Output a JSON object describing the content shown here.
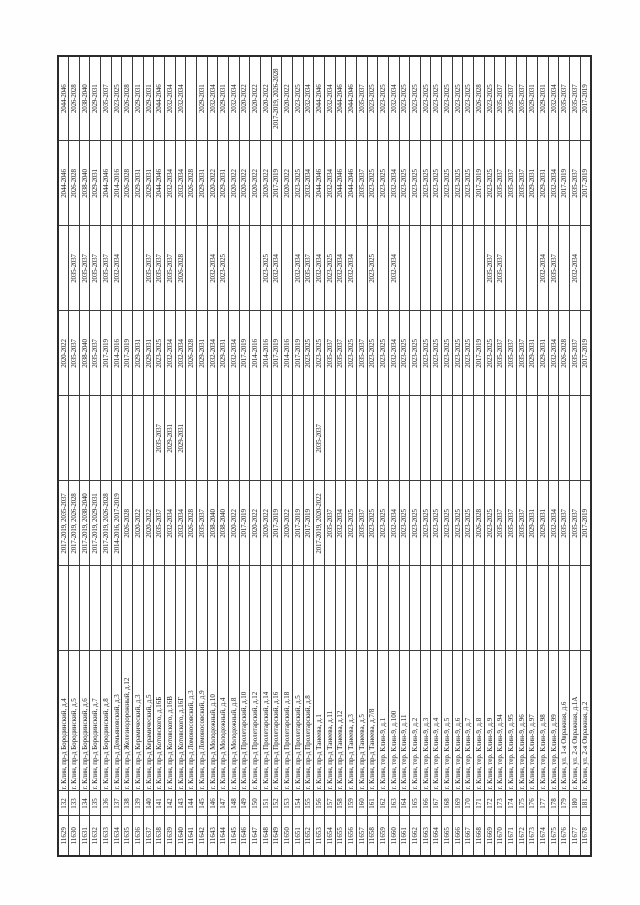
{
  "page": {
    "background": "#ffffff",
    "ink": "#1c1c1c",
    "border": "#3c3c3c"
  },
  "table": {
    "column_widths": [
      40,
      25,
      140,
      85,
      85,
      85,
      85,
      85,
      85,
      85
    ],
    "rows": [
      {
        "id": "11629",
        "num": "132",
        "address": "г. Клин, пр-д Бородинский, д.4",
        "periods": [
          "",
          "2017-2019, 2035-2037",
          "",
          "2020-2022",
          "",
          "2044-2046",
          "2044-2046"
        ]
      },
      {
        "id": "11630",
        "num": "133",
        "address": "г. Клин, пр-д Бородинский, д.5",
        "periods": [
          "",
          "2017-2019, 2026-2028",
          "",
          "2035-2037",
          "2035-2037",
          "2026-2028",
          "2026-2028"
        ]
      },
      {
        "id": "11631",
        "num": "134",
        "address": "г. Клин, пр-д Бородинский, д.6",
        "periods": [
          "",
          "2017-2019, 2038-2040",
          "",
          "2038-2040",
          "2035-2037",
          "2038-2040",
          "2038-2040"
        ]
      },
      {
        "id": "11632",
        "num": "135",
        "address": "г. Клин, пр-д Бородинский, д.7",
        "periods": [
          "",
          "2017-2019, 2029-2031",
          "",
          "2035-2037",
          "2035-2037",
          "2029-2031",
          "2029-2031"
        ]
      },
      {
        "id": "11633",
        "num": "136",
        "address": "г. Клин, пр-д Бородинский, д.8",
        "periods": [
          "",
          "2017-2019, 2026-2028",
          "",
          "2017-2019",
          "2035-2037",
          "2044-2046",
          "2035-2037"
        ]
      },
      {
        "id": "11634",
        "num": "137",
        "address": "г. Клин, пр-д Демьяновский, д.3",
        "periods": [
          "",
          "2014-2016, 2017-2019",
          "",
          "2014-2016",
          "2032-2034",
          "2014-2016",
          "2023-2025"
        ]
      },
      {
        "id": "11635",
        "num": "138",
        "address": "г. Клин, пр-д Железнодорожный, д.12",
        "periods": [
          "",
          "2026-2028",
          "",
          "2017-2019",
          "",
          "2026-2028",
          "2026-2028"
        ]
      },
      {
        "id": "11636",
        "num": "139",
        "address": "г. Клин, пр-д Керамический, д.3",
        "periods": [
          "",
          "2020-2022",
          "",
          "2029-2031",
          "",
          "2029-2031",
          "2029-2031"
        ]
      },
      {
        "id": "11637",
        "num": "140",
        "address": "г. Клин, пр-д Керамический, д.5",
        "periods": [
          "",
          "2020-2022",
          "",
          "2029-2031",
          "2035-2037",
          "2029-2031",
          "2029-2031"
        ]
      },
      {
        "id": "11638",
        "num": "141",
        "address": "г. Клин, пр-д Котовского, д.16Б",
        "periods": [
          "",
          "2035-2037",
          "2035-2037",
          "2023-2025",
          "2035-2037",
          "2044-2046",
          "2044-2046"
        ]
      },
      {
        "id": "11639",
        "num": "142",
        "address": "г. Клин, пр-д Котовского, д.16В",
        "periods": [
          "",
          "2032-2034",
          "2029-2031",
          "2032-2034",
          "2035-2037",
          "2032-2034",
          "2032-2034"
        ]
      },
      {
        "id": "11640",
        "num": "143",
        "address": "г. Клин, пр-д Котовского, д.16Г",
        "periods": [
          "",
          "2032-2034",
          "2029-2031",
          "2032-2034",
          "2026-2028",
          "2032-2034",
          "2032-2034"
        ]
      },
      {
        "id": "11641",
        "num": "144",
        "address": "г. Клин, пр-д Ломоносовский, д.3",
        "periods": [
          "",
          "2026-2028",
          "",
          "2026-2028",
          "",
          "2026-2028",
          ""
        ]
      },
      {
        "id": "11642",
        "num": "145",
        "address": "г. Клин, пр-д Ломоносовский, д.9",
        "periods": [
          "",
          "2035-2037",
          "",
          "2029-2031",
          "",
          "2029-2031",
          "2029-2031"
        ]
      },
      {
        "id": "11643",
        "num": "146",
        "address": "г. Клин, пр-д Молодежный, д.10",
        "periods": [
          "",
          "2038-2040",
          "",
          "2032-2034",
          "2032-2034",
          "2020-2022",
          "2032-2034"
        ]
      },
      {
        "id": "11644",
        "num": "147",
        "address": "г. Клин, пр-д Молодежный, д.4",
        "periods": [
          "",
          "2038-2040",
          "",
          "2029-2031",
          "2023-2025",
          "2029-2031",
          "2029-2031"
        ]
      },
      {
        "id": "11645",
        "num": "148",
        "address": "г. Клин, пр-д Молодежный, д.8",
        "periods": [
          "",
          "2020-2022",
          "",
          "2032-2034",
          "",
          "2020-2022",
          "2032-2034"
        ]
      },
      {
        "id": "11646",
        "num": "149",
        "address": "г. Клин, пр-д Пролетарский, д.10",
        "periods": [
          "",
          "2017-2019",
          "",
          "2017-2019",
          "",
          "2020-2022",
          "2020-2022"
        ]
      },
      {
        "id": "11647",
        "num": "150",
        "address": "г. Клин, пр-д Пролетарский, д.12",
        "periods": [
          "",
          "2020-2022",
          "",
          "2014-2016",
          "",
          "2020-2022",
          "2020-2022"
        ]
      },
      {
        "id": "11648",
        "num": "151",
        "address": "г. Клин, пр-д Пролетарский, д.14",
        "periods": [
          "",
          "2020-2022",
          "",
          "2014-2016",
          "2023-2025",
          "2020-2022",
          "2020-2022"
        ]
      },
      {
        "id": "11649",
        "num": "152",
        "address": "г. Клин, пр-д Пролетарский, д.16",
        "periods": [
          "",
          "2017-2019",
          "",
          "2017-2019",
          "2032-2034",
          "2017-2019",
          "2017-2019, 2026-2028"
        ]
      },
      {
        "id": "11650",
        "num": "153",
        "address": "г. Клин, пр-д Пролетарский, д.18",
        "periods": [
          "",
          "2020-2022",
          "",
          "2014-2016",
          "",
          "2020-2022",
          "2020-2022"
        ]
      },
      {
        "id": "11651",
        "num": "154",
        "address": "г. Клин, пр-д Пролетарский, д.5",
        "periods": [
          "",
          "2017-2019",
          "",
          "2017-2019",
          "2032-2034",
          "2023-2025",
          "2023-2025"
        ]
      },
      {
        "id": "11652",
        "num": "155",
        "address": "г. Клин, пр-д Пролетарский, д.8",
        "periods": [
          "",
          "2017-2019",
          "",
          "2023-2025",
          "2035-2037",
          "2032-2034",
          "2032-2034"
        ]
      },
      {
        "id": "11653",
        "num": "156",
        "address": "г. Клин, пр-д Танеева, д.1",
        "periods": [
          "",
          "2017-2019, 2020-2022",
          "2035-2037",
          "2023-2025",
          "2032-2034",
          "2044-2046",
          "2044-2046"
        ]
      },
      {
        "id": "11654",
        "num": "157",
        "address": "г. Клин, пр-д Танеева, д.11",
        "periods": [
          "",
          "2035-2037",
          "",
          "2035-2037",
          "2023-2025",
          "2032-2034",
          "2032-2034"
        ]
      },
      {
        "id": "11655",
        "num": "158",
        "address": "г. Клин, пр-д Танеева, д.12",
        "periods": [
          "",
          "2032-2034",
          "",
          "2035-2037",
          "2032-2034",
          "2044-2046",
          "2044-2046"
        ]
      },
      {
        "id": "11656",
        "num": "159",
        "address": "г. Клин, пр-д Танеева, д.3",
        "periods": [
          "",
          "2023-2025",
          "",
          "2023-2025",
          "2032-2034",
          "2044-2046",
          "2044-2046"
        ]
      },
      {
        "id": "11657",
        "num": "160",
        "address": "г. Клин, пр-д Танеева, д.5",
        "periods": [
          "",
          "2035-2037",
          "",
          "2035-2037",
          "",
          "2035-2037",
          "2035-2037"
        ]
      },
      {
        "id": "11658",
        "num": "161",
        "address": "г. Клин, пр-д Танеева, д.7/8",
        "periods": [
          "",
          "2023-2025",
          "",
          "2023-2025",
          "2023-2025",
          "2023-2025",
          "2023-2025"
        ]
      },
      {
        "id": "11659",
        "num": "162",
        "address": "г. Клин, тер. Клин-9, д.1",
        "periods": [
          "",
          "2023-2025",
          "",
          "2023-2025",
          "",
          "2023-2025",
          "2023-2025"
        ]
      },
      {
        "id": "11660",
        "num": "163",
        "address": "г. Клин, тер. Клин-9, д.100",
        "periods": [
          "",
          "2032-2034",
          "",
          "2032-2034",
          "2032-2034",
          "2032-2034",
          "2032-2034"
        ]
      },
      {
        "id": "11661",
        "num": "164",
        "address": "г. Клин, тер. Клин-9, д.11",
        "periods": [
          "",
          "2023-2025",
          "",
          "2023-2025",
          "",
          "2023-2025",
          "2023-2025"
        ]
      },
      {
        "id": "11662",
        "num": "165",
        "address": "г. Клин, тер. Клин-9, д.2",
        "periods": [
          "",
          "2023-2025",
          "",
          "2023-2025",
          "",
          "2023-2025",
          "2023-2025"
        ]
      },
      {
        "id": "11663",
        "num": "166",
        "address": "г. Клин, тер. Клин-9, д.3",
        "periods": [
          "",
          "2023-2025",
          "",
          "2023-2025",
          "",
          "2023-2025",
          "2023-2025"
        ]
      },
      {
        "id": "11664",
        "num": "167",
        "address": "г. Клин, тер. Клин-9, д.4",
        "periods": [
          "",
          "2023-2025",
          "",
          "2023-2025",
          "",
          "2023-2025",
          "2023-2025"
        ]
      },
      {
        "id": "11665",
        "num": "168",
        "address": "г. Клин, тер. Клин-9, д.5",
        "periods": [
          "",
          "2023-2025",
          "",
          "2023-2025",
          "",
          "2023-2025",
          "2023-2025"
        ]
      },
      {
        "id": "11666",
        "num": "169",
        "address": "г. Клин, тер. Клин-9, д.6",
        "periods": [
          "",
          "2023-2025",
          "",
          "2023-2025",
          "",
          "2023-2025",
          "2023-2025"
        ]
      },
      {
        "id": "11667",
        "num": "170",
        "address": "г. Клин, тер. Клин-9, д.7",
        "periods": [
          "",
          "2023-2025",
          "",
          "2023-2025",
          "",
          "2023-2025",
          "2023-2025"
        ]
      },
      {
        "id": "11668",
        "num": "171",
        "address": "г. Клин, тер. Клин-9, д.8",
        "periods": [
          "",
          "2026-2028",
          "",
          "2017-2019",
          "",
          "2017-2019",
          "2026-2028"
        ]
      },
      {
        "id": "11669",
        "num": "172",
        "address": "г. Клин, тер. Клин-9, д.9",
        "periods": [
          "",
          "2023-2025",
          "",
          "2023-2025",
          "2035-2037",
          "2023-2025",
          "2023-2025"
        ]
      },
      {
        "id": "11670",
        "num": "173",
        "address": "г. Клин, тер. Клин-9, д.94",
        "periods": [
          "",
          "2035-2037",
          "",
          "2035-2037",
          "2035-2037",
          "2035-2037",
          "2035-2037"
        ]
      },
      {
        "id": "11671",
        "num": "174",
        "address": "г. Клин, тер. Клин-9, д.95",
        "periods": [
          "",
          "2035-2037",
          "",
          "2035-2037",
          "",
          "2035-2037",
          "2035-2037"
        ]
      },
      {
        "id": "11672",
        "num": "175",
        "address": "г. Клин, тер. Клин-9, д.96",
        "periods": [
          "",
          "2035-2037",
          "",
          "2035-2037",
          "",
          "2035-2037",
          "2035-2037"
        ]
      },
      {
        "id": "11673",
        "num": "176",
        "address": "г. Клин, тер. Клин-9, д.97",
        "periods": [
          "",
          "2029-2031",
          "",
          "2029-2031",
          "",
          "2029-2031",
          "2029-2031"
        ]
      },
      {
        "id": "11674",
        "num": "177",
        "address": "г. Клин, тер. Клин-9, д.98",
        "periods": [
          "",
          "2029-2031",
          "",
          "2029-2031",
          "2032-2034",
          "2029-2031",
          "2029-2031"
        ]
      },
      {
        "id": "11675",
        "num": "178",
        "address": "г. Клин, тер. Клин-9, д.99",
        "periods": [
          "",
          "2032-2034",
          "",
          "2032-2034",
          "2035-2037",
          "2032-2034",
          "2032-2034"
        ]
      },
      {
        "id": "11676",
        "num": "179",
        "address": "г. Клин, ул. 1-я Овражная, д.6",
        "periods": [
          "",
          "2035-2037",
          "",
          "2026-2028",
          "",
          "2017-2019",
          "2035-2037"
        ]
      },
      {
        "id": "11677",
        "num": "180",
        "address": "г. Клин, ул. 2-я Овражная, д.1А",
        "periods": [
          "",
          "2035-2037",
          "",
          "2035-2037",
          "2032-2034",
          "2035-2037",
          "2035-2037"
        ]
      },
      {
        "id": "11678",
        "num": "181",
        "address": "г. Клин, ул. 2-я Овражная, д.2",
        "periods": [
          "",
          "2017-2019",
          "",
          "2017-2019",
          "",
          "2017-2019",
          "2017-2019"
        ]
      }
    ]
  }
}
